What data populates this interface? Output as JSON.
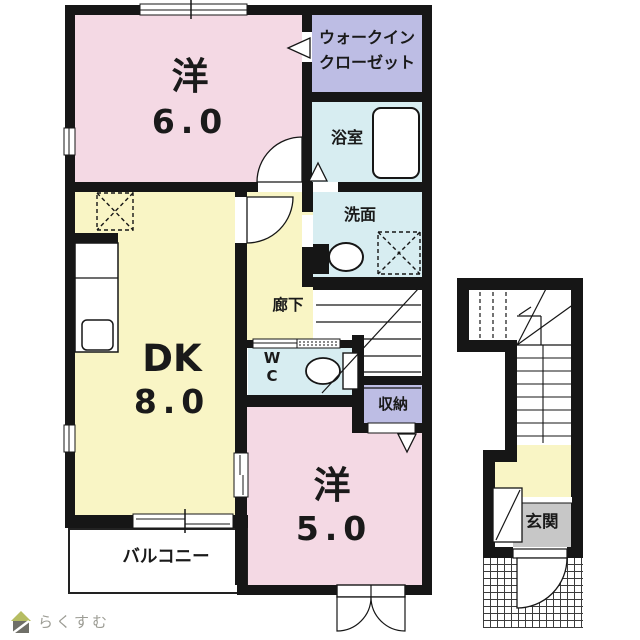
{
  "plan": {
    "rooms": {
      "west_room_6": {
        "label": "洋",
        "size": "6.0"
      },
      "walk_in_closet": {
        "line1": "ウォークイン",
        "line2": "クローゼット"
      },
      "bathroom": {
        "label": "浴室"
      },
      "washroom": {
        "label": "洗面"
      },
      "hallway": {
        "label": "廊下"
      },
      "wc": {
        "line1": "W",
        "line2": "C"
      },
      "storage": {
        "label": "収納"
      },
      "dining_kitchen": {
        "label": "DK",
        "size": "8.0"
      },
      "west_room_5": {
        "label": "洋",
        "size": "5.0"
      },
      "balcony": {
        "label": "バルコニー"
      },
      "entrance": {
        "label": "玄関"
      }
    }
  },
  "branding": {
    "logo_text": "らくすむ"
  },
  "colors": {
    "room_pink": "#f4d9e4",
    "room_yellow": "#f9f5c5",
    "room_purple": "#bdbde4",
    "room_cyan": "#d7edf1",
    "entrance_gray": "#c7c7c7",
    "wall_black": "#161616",
    "logo_roof_green": "#b6bd62",
    "logo_text_gray": "#9c9c94"
  }
}
